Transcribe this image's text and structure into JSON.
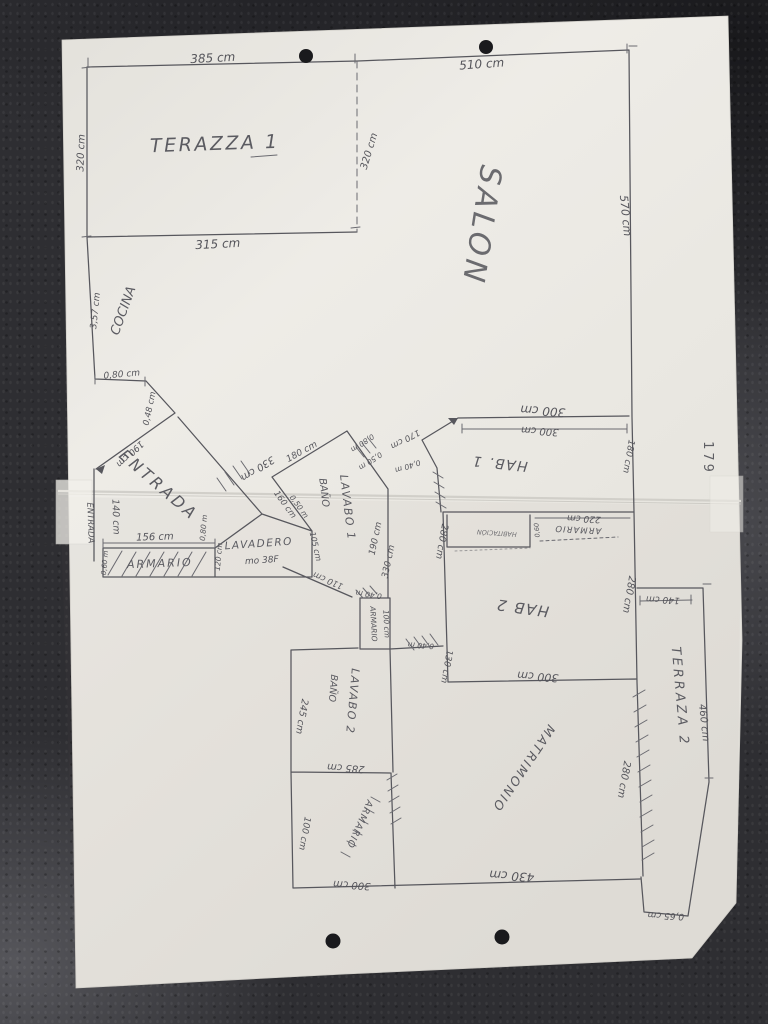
{
  "photo": {
    "page_number": "179"
  },
  "colors": {
    "background": "#2e2e32",
    "paper": "#eae8e2",
    "ink": "#57575d",
    "faint_ink": "#97959c"
  },
  "rooms": {
    "terazza1": "TERAZZA 1",
    "salon": "SALON",
    "cocina": "COCINA",
    "entrada_main": "ENTRADA",
    "entrada_side": "ENTRADA",
    "armario_entrada": "ARMARIO",
    "lavadero": "LAVADERO",
    "lavadero_area": "mo 38F",
    "banio1": "BAÑO",
    "lavabo1": "LAVABO 1",
    "hab1": "HAB. 1",
    "hab1_closet_note": "HABITACIÓN",
    "armario_hab1": "ARMARIO",
    "hab2": "HAB 2",
    "banio2": "BAÑO",
    "lavabo2": "LAVABO 2",
    "armario_pasillo": "ARMARIO",
    "armario_dorm": "ARMARIO",
    "matrimonio": "MATRIMONIO",
    "terraza2": "TERRAZA 2"
  },
  "dimensions": {
    "terr1_top": "385 cm",
    "salon_top": "510 cm",
    "terr1_left": "320 cm",
    "terr1_right": "320 cm",
    "terr1_bottom": "315 cm",
    "salon_right": "570 cm",
    "cocina_left": "3,57 cm",
    "cocina_step": "0,80 cm",
    "cocina_notch": "0,48 cm",
    "entrada_diag": "190 cm",
    "entrada_wall": "140 cm",
    "armario_entrada_w": "156 cm",
    "armario_entrada_left": "0,60 m",
    "armario_entrada_right": "0,80 m",
    "armario_entrada_depth": "120 cm",
    "pasillo_diag": "330 cm",
    "banio1_diag_top": "180 cm",
    "banio1_seg1": "0,80 m",
    "banio1_seg2": "0,50 m",
    "banio1_seg3": "0,40 m",
    "hab1_entry_diag": "170 cm",
    "banio1_diag_bottom": "160 cm",
    "banio1_seg4": "0,50 m",
    "lavadero_right": "105 cm",
    "pasillo_wall_a": "190 cm",
    "pasillo_wall_b": "330 cm",
    "armario_pasillo_top": "0,40 m",
    "armario_pasillo_h": "100 cm",
    "matrimonio_door": "0,40 m",
    "hab1_top_outer": "300 cm",
    "hab1_top_inner": "300 cm",
    "hab1_right": "180 cm",
    "armario_hab1_w": "220 cm",
    "armario_hab1_d": "0,60",
    "hab2_left": "280 cm",
    "hab2_right": "280 cm",
    "hab2_bottom": "300 cm",
    "hab2_left_lower": "130 cm",
    "terr2_top": "140 cm",
    "terr2_right": "460 cm",
    "terr2_left": "280 cm",
    "lavabo2_left": "245 cm",
    "lavabo2_bottom": "285 cm",
    "lavabo2_diag": "110 cm",
    "dorm3_left": "100 cm",
    "dorm3_bottom": "300 cm",
    "matrimonio_bottom": "430 cm",
    "terr2_notch": "0,65 cm"
  }
}
